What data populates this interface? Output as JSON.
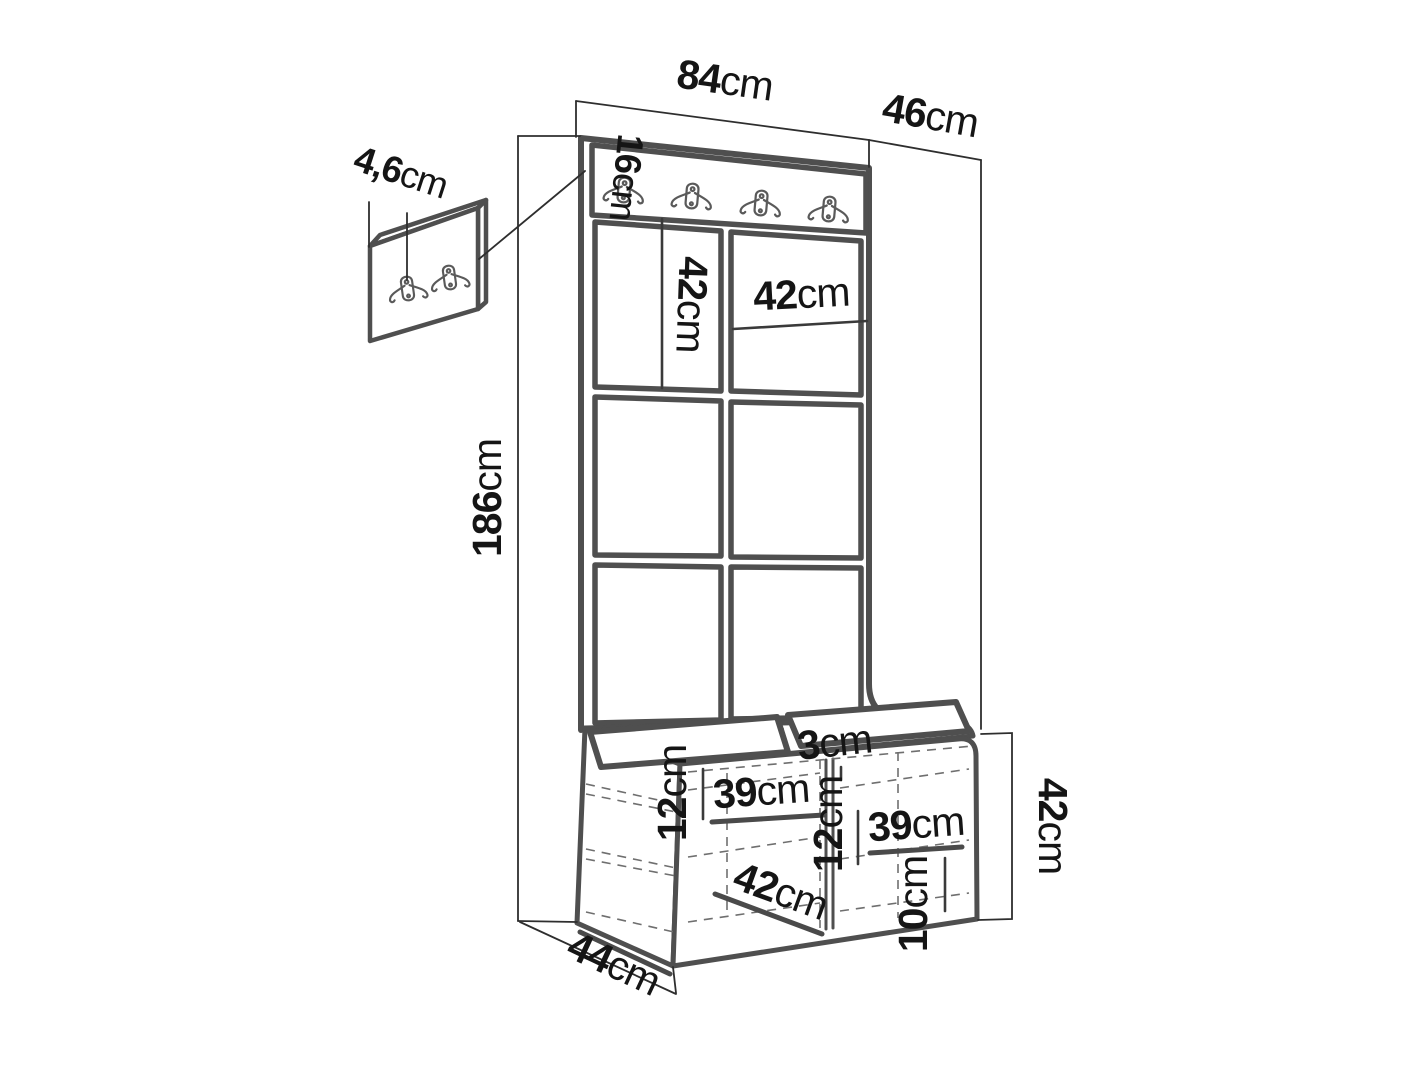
{
  "diagram": {
    "type": "furniture-dimension-drawing",
    "subject": "hallway set: coat-hook wall panel with upholstered tiles, shoe bench and small wall hook panel",
    "colors": {
      "line": "#4f4f4f",
      "dimension": "#2e2e2e",
      "text": "#151515",
      "dashed": "#6f6f6f",
      "background": "#ffffff"
    },
    "hooks": {
      "main_rail_count": 4,
      "wall_panel_count": 2
    },
    "dims": {
      "width": {
        "value": "84",
        "unit": "cm"
      },
      "side_depth": {
        "value": "46",
        "unit": "cm"
      },
      "rail_height": {
        "value": "16",
        "unit": "cm"
      },
      "hook_panel_thickness": {
        "value": "4,6",
        "unit": "cm"
      },
      "total_height": {
        "value": "186",
        "unit": "cm"
      },
      "tile_height": {
        "value": "42",
        "unit": "cm"
      },
      "tile_width": {
        "value": "42",
        "unit": "cm"
      },
      "cushion_thickness": {
        "value": "3",
        "unit": "cm"
      },
      "left_shelf_drop": {
        "value": "12",
        "unit": "cm"
      },
      "left_shelf_width": {
        "value": "39",
        "unit": "cm"
      },
      "right_shelf_drop": {
        "value": "12",
        "unit": "cm"
      },
      "right_shelf_width": {
        "value": "39",
        "unit": "cm"
      },
      "bench_inner_depth": {
        "value": "42",
        "unit": "cm"
      },
      "bottom_clearance": {
        "value": "10",
        "unit": "cm"
      },
      "bench_height": {
        "value": "42",
        "unit": "cm"
      },
      "bench_depth": {
        "value": "44",
        "unit": "cm"
      }
    }
  }
}
